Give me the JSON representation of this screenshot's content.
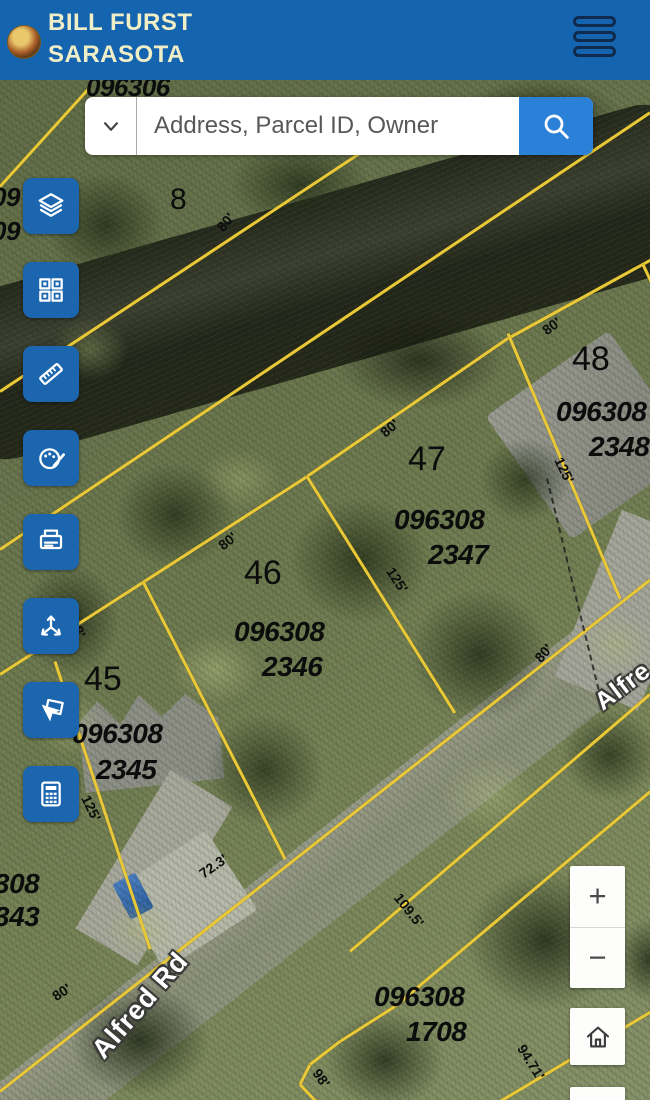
{
  "header": {
    "title_line1": "BILL FURST",
    "title_line2": "SARASOTA",
    "logo": "county-seal-logo",
    "menu_icon": "hamburger-menu-icon"
  },
  "search": {
    "placeholder": "Address, Parcel ID, Owner",
    "dropdown_icon": "chevron-down-icon",
    "submit_icon": "search-icon"
  },
  "toolbar": {
    "buttons": [
      "layers-icon",
      "basemap-grid-icon",
      "measure-ruler-icon",
      "draw-palette-icon",
      "print-icon",
      "directions-icon",
      "select-features-icon",
      "calculator-icon"
    ]
  },
  "map": {
    "streets": [
      "Alfred Rd",
      "Alfre"
    ],
    "lot_numbers": [
      "8",
      "45",
      "46",
      "47",
      "48"
    ],
    "parcels": [
      {
        "line1": "096308",
        "line2": "2347"
      },
      {
        "line1": "096308",
        "line2": "2346"
      },
      {
        "line1": "096308",
        "line2": "2345"
      },
      {
        "line1": "096308",
        "line2": "2348"
      },
      {
        "line1": "096308",
        "line2": "1708"
      }
    ],
    "partial_labels": [
      "096306",
      "308",
      "343",
      "09",
      "09"
    ],
    "dimensions": [
      "80'",
      "80'",
      "80'",
      "80'",
      "80'",
      "80'",
      "125'",
      "125'",
      "125'",
      "72.3'",
      "109.5'",
      "94.71'",
      "98'",
      "8'"
    ],
    "colors": {
      "header_blue": "#1464af",
      "toolbar_blue": "#1b66ae",
      "search_button_blue": "#2b80d8",
      "parcel_line_yellow": "#e9c937"
    }
  },
  "zoom_controls": {
    "zoom_in": "+",
    "zoom_out": "−"
  },
  "home_button": {
    "icon": "home-icon"
  }
}
